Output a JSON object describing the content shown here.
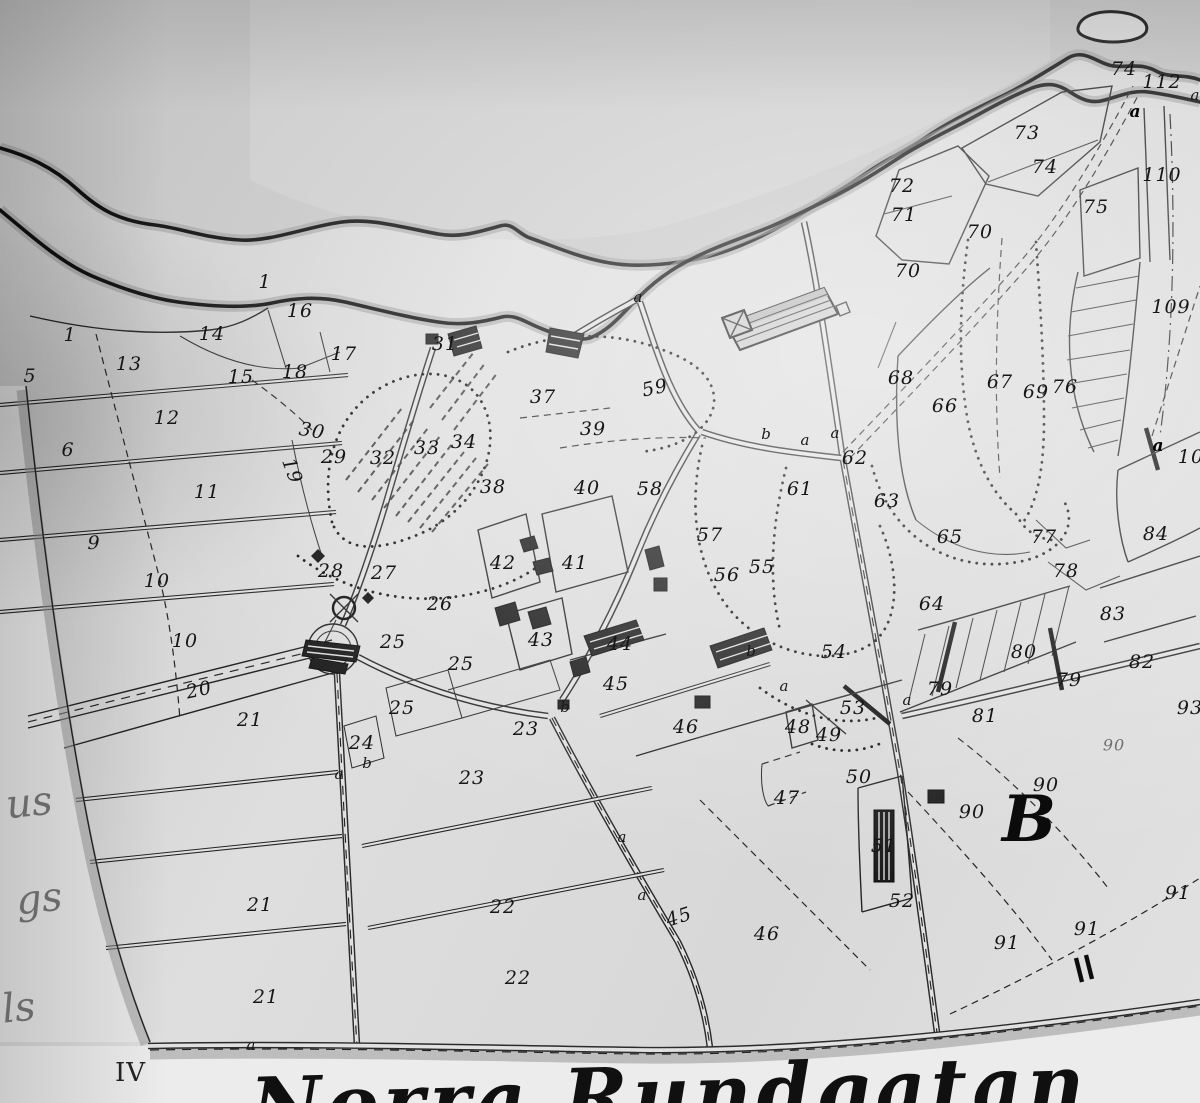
{
  "map": {
    "street_name": "Norra Rundgatan",
    "sheet_numeral": "IV",
    "block_letter": "B",
    "colors": {
      "paper": "#dedede",
      "water": "#c7c7c7",
      "ink": "#161616",
      "shade": "#979797"
    },
    "edge_fragments": [
      {
        "t": "us",
        "x": 6,
        "y": 780
      },
      {
        "t": "gs",
        "x": 16,
        "y": 876
      },
      {
        "t": "ls",
        "x": 2,
        "y": 985
      }
    ],
    "boundary_letters": [
      {
        "t": "a",
        "x": 638,
        "y": 297
      },
      {
        "t": "b",
        "x": 766,
        "y": 434
      },
      {
        "t": "a",
        "x": 805,
        "y": 440
      },
      {
        "t": "a",
        "x": 835,
        "y": 433
      },
      {
        "t": "a",
        "x": 1135,
        "y": 112,
        "b": 1
      },
      {
        "t": "a",
        "x": 1195,
        "y": 95
      },
      {
        "t": "a",
        "x": 1158,
        "y": 446,
        "b": 1
      },
      {
        "t": "a",
        "x": 784,
        "y": 686
      },
      {
        "t": "a",
        "x": 907,
        "y": 700
      },
      {
        "t": "b",
        "x": 751,
        "y": 651
      },
      {
        "t": "b",
        "x": 565,
        "y": 707
      },
      {
        "t": "a",
        "x": 339,
        "y": 774
      },
      {
        "t": "b",
        "x": 367,
        "y": 763
      },
      {
        "t": "a",
        "x": 622,
        "y": 837
      },
      {
        "t": "a",
        "x": 642,
        "y": 895
      },
      {
        "t": "a",
        "x": 251,
        "y": 1045
      }
    ],
    "parcel_labels": [
      {
        "t": "1",
        "x": 70,
        "y": 335
      },
      {
        "t": "1",
        "x": 265,
        "y": 282
      },
      {
        "t": "5",
        "x": 30,
        "y": 376
      },
      {
        "t": "6",
        "x": 68,
        "y": 450
      },
      {
        "t": "9",
        "x": 94,
        "y": 543
      },
      {
        "t": "10",
        "x": 157,
        "y": 581
      },
      {
        "t": "10",
        "x": 185,
        "y": 641
      },
      {
        "t": "11",
        "x": 207,
        "y": 492
      },
      {
        "t": "12",
        "x": 167,
        "y": 418
      },
      {
        "t": "13",
        "x": 129,
        "y": 364
      },
      {
        "t": "14",
        "x": 212,
        "y": 334
      },
      {
        "t": "15",
        "x": 241,
        "y": 377
      },
      {
        "t": "16",
        "x": 300,
        "y": 311
      },
      {
        "t": "17",
        "x": 344,
        "y": 354
      },
      {
        "t": "18",
        "x": 295,
        "y": 372
      },
      {
        "t": "19",
        "x": 292,
        "y": 471,
        "r": 70
      },
      {
        "t": "30",
        "x": 312,
        "y": 431,
        "r": 10
      },
      {
        "t": "29",
        "x": 334,
        "y": 457
      },
      {
        "t": "28",
        "x": 331,
        "y": 571
      },
      {
        "t": "27",
        "x": 384,
        "y": 573
      },
      {
        "t": "26",
        "x": 440,
        "y": 604
      },
      {
        "t": "25",
        "x": 393,
        "y": 642
      },
      {
        "t": "25",
        "x": 461,
        "y": 664
      },
      {
        "t": "25",
        "x": 402,
        "y": 708
      },
      {
        "t": "24",
        "x": 362,
        "y": 743
      },
      {
        "t": "23",
        "x": 526,
        "y": 729
      },
      {
        "t": "23",
        "x": 472,
        "y": 778
      },
      {
        "t": "20",
        "x": 199,
        "y": 690,
        "r": -12
      },
      {
        "t": "21",
        "x": 250,
        "y": 720
      },
      {
        "t": "21",
        "x": 260,
        "y": 905
      },
      {
        "t": "21",
        "x": 266,
        "y": 997
      },
      {
        "t": "22",
        "x": 503,
        "y": 907
      },
      {
        "t": "22",
        "x": 518,
        "y": 978
      },
      {
        "t": "31",
        "x": 445,
        "y": 344
      },
      {
        "t": "32",
        "x": 383,
        "y": 458
      },
      {
        "t": "33",
        "x": 427,
        "y": 448
      },
      {
        "t": "34",
        "x": 464,
        "y": 442
      },
      {
        "t": "37",
        "x": 543,
        "y": 397
      },
      {
        "t": "38",
        "x": 493,
        "y": 487
      },
      {
        "t": "39",
        "x": 593,
        "y": 429
      },
      {
        "t": "40",
        "x": 587,
        "y": 488
      },
      {
        "t": "41",
        "x": 575,
        "y": 563
      },
      {
        "t": "42",
        "x": 503,
        "y": 563
      },
      {
        "t": "43",
        "x": 541,
        "y": 640
      },
      {
        "t": "44",
        "x": 620,
        "y": 644
      },
      {
        "t": "45",
        "x": 616,
        "y": 684
      },
      {
        "t": "45",
        "x": 679,
        "y": 917,
        "r": -18
      },
      {
        "t": "46",
        "x": 686,
        "y": 727
      },
      {
        "t": "46",
        "x": 767,
        "y": 934
      },
      {
        "t": "47",
        "x": 787,
        "y": 798
      },
      {
        "t": "48",
        "x": 798,
        "y": 727
      },
      {
        "t": "49",
        "x": 829,
        "y": 735
      },
      {
        "t": "50",
        "x": 859,
        "y": 777
      },
      {
        "t": "51",
        "x": 884,
        "y": 846
      },
      {
        "t": "52",
        "x": 902,
        "y": 901
      },
      {
        "t": "53",
        "x": 853,
        "y": 708
      },
      {
        "t": "54",
        "x": 834,
        "y": 652
      },
      {
        "t": "55",
        "x": 762,
        "y": 567
      },
      {
        "t": "56",
        "x": 727,
        "y": 575
      },
      {
        "t": "57",
        "x": 710,
        "y": 535
      },
      {
        "t": "58",
        "x": 650,
        "y": 489
      },
      {
        "t": "59",
        "x": 655,
        "y": 388,
        "r": -12
      },
      {
        "t": "61",
        "x": 800,
        "y": 489
      },
      {
        "t": "62",
        "x": 855,
        "y": 458
      },
      {
        "t": "63",
        "x": 887,
        "y": 501
      },
      {
        "t": "64",
        "x": 932,
        "y": 604
      },
      {
        "t": "65",
        "x": 950,
        "y": 537
      },
      {
        "t": "66",
        "x": 945,
        "y": 406
      },
      {
        "t": "67",
        "x": 1000,
        "y": 382
      },
      {
        "t": "68",
        "x": 901,
        "y": 378
      },
      {
        "t": "69",
        "x": 1036,
        "y": 392
      },
      {
        "t": "70",
        "x": 908,
        "y": 271
      },
      {
        "t": "70",
        "x": 980,
        "y": 232
      },
      {
        "t": "71",
        "x": 904,
        "y": 215
      },
      {
        "t": "72",
        "x": 902,
        "y": 186
      },
      {
        "t": "73",
        "x": 1027,
        "y": 133
      },
      {
        "t": "74",
        "x": 1045,
        "y": 167
      },
      {
        "t": "74",
        "x": 1124,
        "y": 69
      },
      {
        "t": "75",
        "x": 1096,
        "y": 207
      },
      {
        "t": "76",
        "x": 1065,
        "y": 387
      },
      {
        "t": "77",
        "x": 1044,
        "y": 537
      },
      {
        "t": "78",
        "x": 1066,
        "y": 571
      },
      {
        "t": "79",
        "x": 940,
        "y": 689
      },
      {
        "t": "79",
        "x": 1069,
        "y": 680
      },
      {
        "t": "80",
        "x": 1024,
        "y": 652
      },
      {
        "t": "81",
        "x": 985,
        "y": 716
      },
      {
        "t": "82",
        "x": 1142,
        "y": 662
      },
      {
        "t": "83",
        "x": 1113,
        "y": 614
      },
      {
        "t": "84",
        "x": 1156,
        "y": 534
      },
      {
        "t": "90",
        "x": 972,
        "y": 812
      },
      {
        "t": "90",
        "x": 1046,
        "y": 785
      },
      {
        "t": "90",
        "x": 1114,
        "y": 745,
        "f": 1
      },
      {
        "t": "91",
        "x": 1007,
        "y": 943
      },
      {
        "t": "91",
        "x": 1087,
        "y": 929
      },
      {
        "t": "91",
        "x": 1178,
        "y": 893
      },
      {
        "t": "93",
        "x": 1190,
        "y": 708
      },
      {
        "t": "109",
        "x": 1171,
        "y": 307
      },
      {
        "t": "110",
        "x": 1162,
        "y": 175
      },
      {
        "t": "112",
        "x": 1162,
        "y": 82
      },
      {
        "t": "10",
        "x": 1191,
        "y": 457
      }
    ]
  }
}
